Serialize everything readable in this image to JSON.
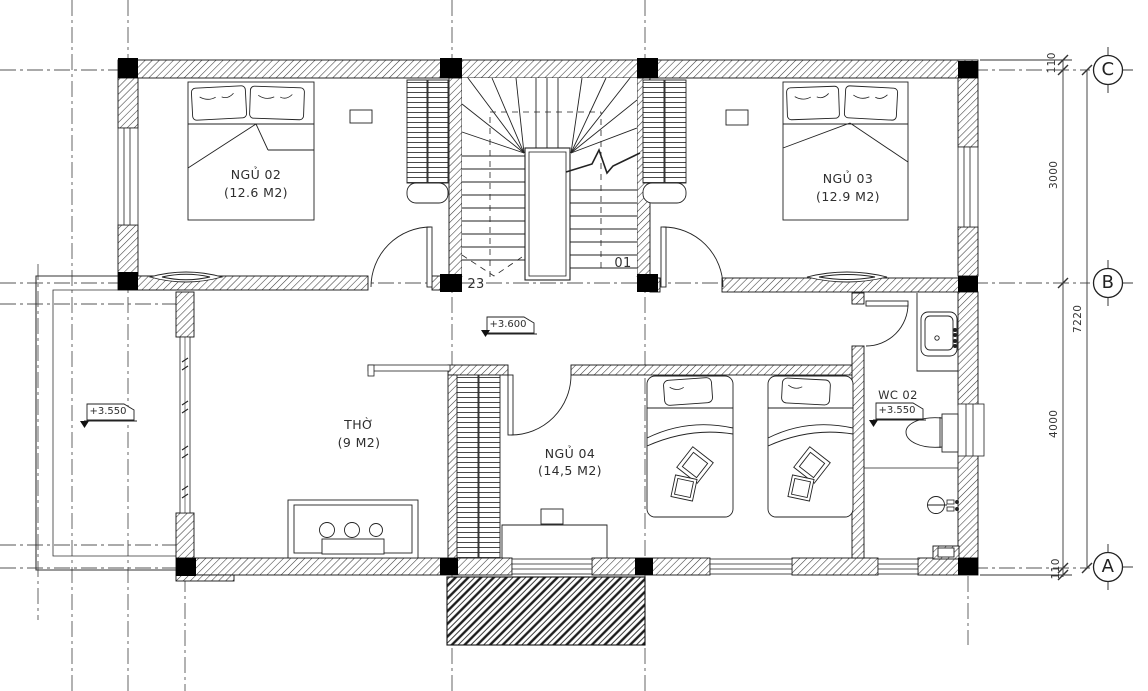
{
  "plan": {
    "rooms": [
      {
        "name": "NGỦ 02",
        "area": "(12.6 M2)"
      },
      {
        "name": "NGỦ 03",
        "area": "(12.9 M2)"
      },
      {
        "name": "THỜ",
        "area": "(9 M2)"
      },
      {
        "name": "NGỦ 04",
        "area": "(14,5 M2)"
      }
    ],
    "wc": {
      "name": "WC 02",
      "level": "+3.550"
    },
    "levels": {
      "hall": "+3.600",
      "balcony": "+3.550"
    },
    "stairs": {
      "step_top": "01",
      "step_bottom": "23"
    },
    "grid": {
      "row_c": "C",
      "row_b": "B",
      "row_a": "A"
    },
    "dims": {
      "seg_top": "110",
      "c_to_b": "3000",
      "b_to_a": "4000",
      "seg_bottom": "110",
      "total": "7220"
    },
    "colors": {
      "line": "#1b1b1b",
      "grid_line": "#555555",
      "column_fill": "#000000",
      "paper": "#ffffff"
    }
  }
}
